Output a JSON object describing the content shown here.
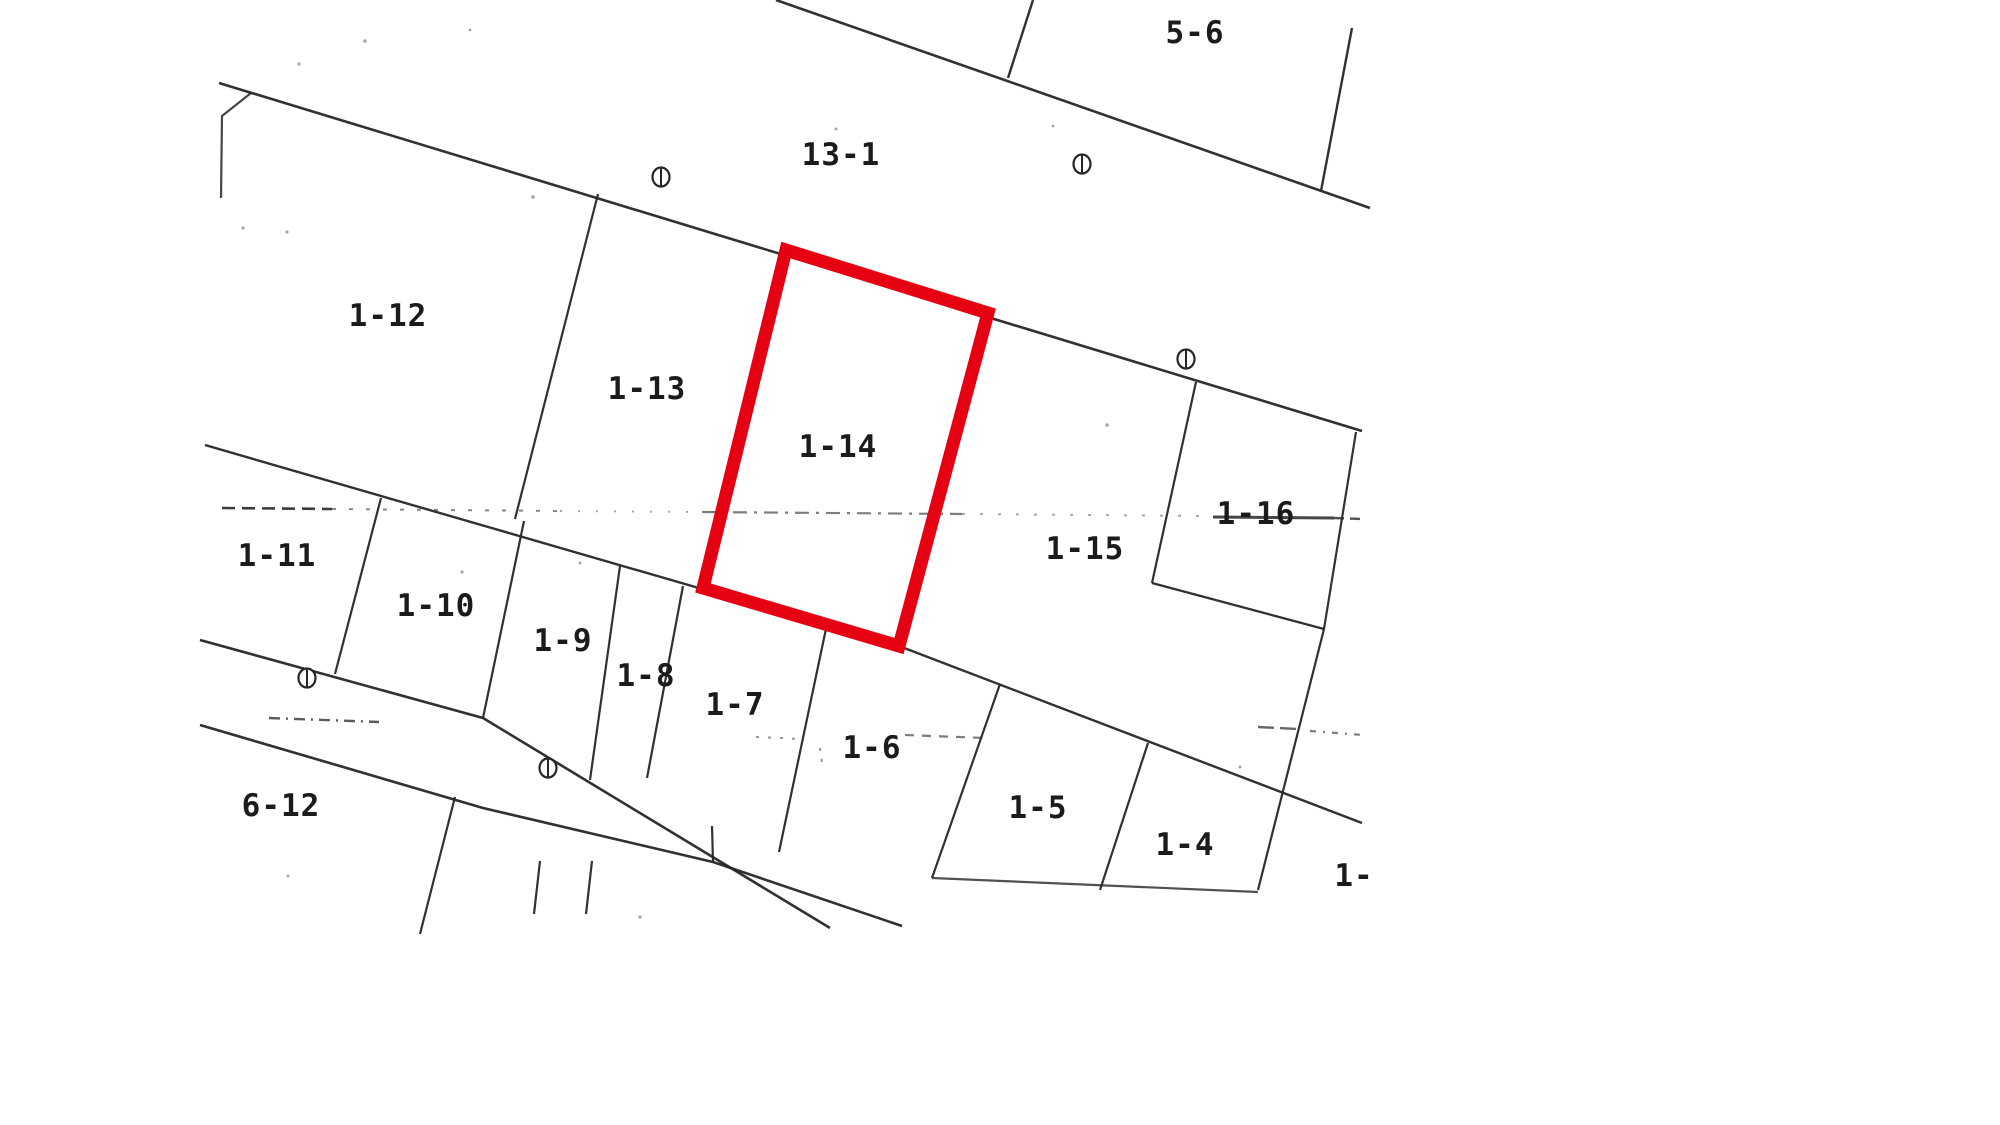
{
  "canvas": {
    "width": 2000,
    "height": 1125,
    "background": "#ffffff"
  },
  "map": {
    "type": "cadastral-parcel-map",
    "line_color": "#262626",
    "speck_color": "#8f8f8f",
    "highlight_color": "#e60112",
    "selected_parcel": "1-14",
    "labels": [
      {
        "text": "5-6",
        "x": 1195,
        "y": 33
      },
      {
        "text": "13-1",
        "x": 841,
        "y": 155
      },
      {
        "text": "1-12",
        "x": 388,
        "y": 316
      },
      {
        "text": "1-13",
        "x": 647,
        "y": 389
      },
      {
        "text": "1-14",
        "x": 838,
        "y": 447
      },
      {
        "text": "1-16",
        "x": 1256,
        "y": 514
      },
      {
        "text": "1-15",
        "x": 1085,
        "y": 549
      },
      {
        "text": "1-11",
        "x": 277,
        "y": 556
      },
      {
        "text": "1-10",
        "x": 436,
        "y": 606
      },
      {
        "text": "1-9",
        "x": 563,
        "y": 641
      },
      {
        "text": "1-8",
        "x": 646,
        "y": 676
      },
      {
        "text": "1-7",
        "x": 735,
        "y": 705
      },
      {
        "text": "1-6",
        "x": 872,
        "y": 748
      },
      {
        "text": "1-5",
        "x": 1038,
        "y": 808
      },
      {
        "text": "1-4",
        "x": 1185,
        "y": 845
      },
      {
        "text": "6-12",
        "x": 281,
        "y": 806
      },
      {
        "text": "1-",
        "x": 1354,
        "y": 876
      }
    ],
    "survey_markers": [
      [
        661,
        177
      ],
      [
        1082,
        164
      ],
      [
        1186,
        359
      ],
      [
        307,
        678
      ],
      [
        548,
        768
      ]
    ],
    "red_parcel": {
      "points": [
        [
          786,
          250
        ],
        [
          988,
          313
        ],
        [
          899,
          646
        ],
        [
          703,
          588
        ]
      ],
      "stroke_width": 13
    },
    "lines": [
      {
        "name": "north-road-upper-edge",
        "points": [
          [
            776,
            0
          ],
          [
            1370,
            208
          ]
        ],
        "w": 2.6
      },
      {
        "name": "north-road-lower-edge",
        "points": [
          [
            219,
            83
          ],
          [
            1362,
            431
          ]
        ],
        "w": 2.6
      },
      {
        "name": "parcel-5-6-east-boundary",
        "points": [
          [
            1352,
            28
          ],
          [
            1321,
            191
          ]
        ],
        "w": 2.4
      },
      {
        "name": "top-edge-vertical-boundary",
        "points": [
          [
            1033,
            0
          ],
          [
            1008,
            78
          ]
        ],
        "w": 2.4
      },
      {
        "name": "northwest-corner-notch",
        "points": [
          [
            251,
            93
          ],
          [
            222,
            116
          ],
          [
            221,
            198
          ]
        ],
        "w": 2.2,
        "opacity": 0.85
      },
      {
        "name": "boundary-1-12-1-13",
        "points": [
          [
            598,
            194
          ],
          [
            515,
            519
          ]
        ],
        "w": 2.2
      },
      {
        "name": "mid-block-south-boundary",
        "points": [
          [
            205,
            445
          ],
          [
            899,
            646
          ],
          [
            1362,
            823
          ]
        ],
        "w": 2.4
      },
      {
        "name": "boundary-1-11-1-10",
        "points": [
          [
            381,
            498
          ],
          [
            335,
            674
          ]
        ],
        "w": 2.2
      },
      {
        "name": "boundary-1-10-1-9",
        "points": [
          [
            524,
            521
          ],
          [
            483,
            718
          ]
        ],
        "w": 2.2
      },
      {
        "name": "boundary-1-9-1-8",
        "points": [
          [
            620,
            566
          ],
          [
            590,
            780
          ]
        ],
        "w": 2.2
      },
      {
        "name": "boundary-1-8-1-7",
        "points": [
          [
            683,
            586
          ],
          [
            647,
            778
          ]
        ],
        "w": 2.2
      },
      {
        "name": "boundary-1-7-1-6",
        "points": [
          [
            827,
            624
          ],
          [
            779,
            852
          ]
        ],
        "w": 2.2
      },
      {
        "name": "boundary-1-6-1-5",
        "points": [
          [
            1000,
            684
          ],
          [
            932,
            878
          ]
        ],
        "w": 2.2
      },
      {
        "name": "boundary-1-5-1-4",
        "points": [
          [
            1148,
            743
          ],
          [
            1100,
            890
          ]
        ],
        "w": 2.2
      },
      {
        "name": "boundary-1-16-east",
        "points": [
          [
            1356,
            432
          ],
          [
            1324,
            629
          ],
          [
            1258,
            890
          ]
        ],
        "w": 2.2
      },
      {
        "name": "boundary-1-16-west",
        "points": [
          [
            1196,
            382
          ],
          [
            1152,
            583
          ]
        ],
        "w": 2.2
      },
      {
        "name": "boundary-1-16-south",
        "points": [
          [
            1152,
            583
          ],
          [
            1324,
            629
          ]
        ],
        "w": 2.2
      },
      {
        "name": "south-road-upper-edge",
        "points": [
          [
            200,
            640
          ],
          [
            483,
            718
          ],
          [
            830,
            928
          ]
        ],
        "w": 2.6
      },
      {
        "name": "south-road-lower-edge",
        "points": [
          [
            200,
            725
          ],
          [
            483,
            808
          ],
          [
            713,
            862
          ],
          [
            902,
            926
          ]
        ],
        "w": 2.6
      },
      {
        "name": "parcel-1-5-1-4-south-edge",
        "points": [
          [
            932,
            878
          ],
          [
            1258,
            892
          ]
        ],
        "w": 2.2,
        "opacity": 0.8
      },
      {
        "name": "small-boundary-a",
        "points": [
          [
            540,
            861
          ],
          [
            534,
            914
          ]
        ],
        "w": 2.2
      },
      {
        "name": "small-boundary-b",
        "points": [
          [
            592,
            861
          ],
          [
            586,
            914
          ]
        ],
        "w": 2.2
      },
      {
        "name": "boundary-6-12-east",
        "points": [
          [
            455,
            797
          ],
          [
            420,
            934
          ]
        ],
        "w": 2.2
      },
      {
        "name": "small-boundary-c",
        "points": [
          [
            712,
            826
          ],
          [
            713,
            862
          ]
        ],
        "w": 2.2
      },
      {
        "name": "center-dashline-1",
        "points": [
          [
            222,
            508
          ],
          [
            332,
            509
          ]
        ],
        "w": 2.6,
        "dash": "13 7",
        "opacity": 0.9
      },
      {
        "name": "center-dashline-2",
        "points": [
          [
            332,
            509
          ],
          [
            560,
            511
          ]
        ],
        "w": 2.0,
        "dash": "4 13",
        "opacity": 0.55
      },
      {
        "name": "center-dashline-3",
        "points": [
          [
            560,
            511
          ],
          [
            702,
            512
          ]
        ],
        "w": 2.0,
        "dash": "2 16",
        "opacity": 0.4
      },
      {
        "name": "center-dashline-4",
        "points": [
          [
            702,
            512
          ],
          [
            962,
            514
          ]
        ],
        "w": 2.2,
        "dash": "14 7 3 7",
        "opacity": 0.6
      },
      {
        "name": "center-dashline-5",
        "points": [
          [
            962,
            514
          ],
          [
            1213,
            516
          ]
        ],
        "w": 2.0,
        "dash": "3 15",
        "opacity": 0.4
      },
      {
        "name": "center-dashline-6",
        "points": [
          [
            1213,
            517
          ],
          [
            1334,
            518
          ]
        ],
        "w": 3.0,
        "opacity": 0.85
      },
      {
        "name": "center-dashline-7",
        "points": [
          [
            1334,
            518
          ],
          [
            1362,
            519
          ]
        ],
        "w": 2.4,
        "dash": "10 6",
        "opacity": 0.8
      },
      {
        "name": "lower-dashline-1",
        "points": [
          [
            269,
            718
          ],
          [
            379,
            722
          ]
        ],
        "w": 2.4,
        "dash": "11 6 2 6",
        "opacity": 0.75
      },
      {
        "name": "lower-dashline-2",
        "points": [
          [
            756,
            737
          ],
          [
            802,
            739
          ]
        ],
        "w": 2.0,
        "dash": "3 9",
        "opacity": 0.5
      },
      {
        "name": "lower-dashline-3",
        "points": [
          [
            820,
            748
          ],
          [
            822,
            762
          ]
        ],
        "w": 2.0,
        "dash": "3 8",
        "opacity": 0.5
      },
      {
        "name": "lower-dashline-4",
        "points": [
          [
            905,
            735
          ],
          [
            985,
            738
          ]
        ],
        "w": 2.2,
        "dash": "9 8",
        "opacity": 0.6
      },
      {
        "name": "lower-dashline-5",
        "points": [
          [
            1258,
            727
          ],
          [
            1298,
            729
          ]
        ],
        "w": 2.4,
        "dash": "16 6",
        "opacity": 0.7
      },
      {
        "name": "lower-dashline-6",
        "points": [
          [
            1310,
            731
          ],
          [
            1363,
            735
          ]
        ],
        "w": 2.2,
        "dash": "6 7 2 7",
        "opacity": 0.6
      }
    ],
    "specks": [
      [
        365,
        41,
        1.8
      ],
      [
        299,
        64,
        1.6
      ],
      [
        533,
        197,
        1.8
      ],
      [
        243,
        228,
        1.6
      ],
      [
        287,
        232,
        1.6
      ],
      [
        462,
        572,
        1.6
      ],
      [
        1107,
        425,
        1.8
      ],
      [
        580,
        563,
        1.5
      ],
      [
        836,
        129,
        1.5
      ],
      [
        640,
        917,
        1.6
      ],
      [
        1240,
        767,
        1.5
      ],
      [
        288,
        876,
        1.5
      ],
      [
        470,
        30,
        1.4
      ],
      [
        1053,
        126,
        1.4
      ]
    ]
  }
}
